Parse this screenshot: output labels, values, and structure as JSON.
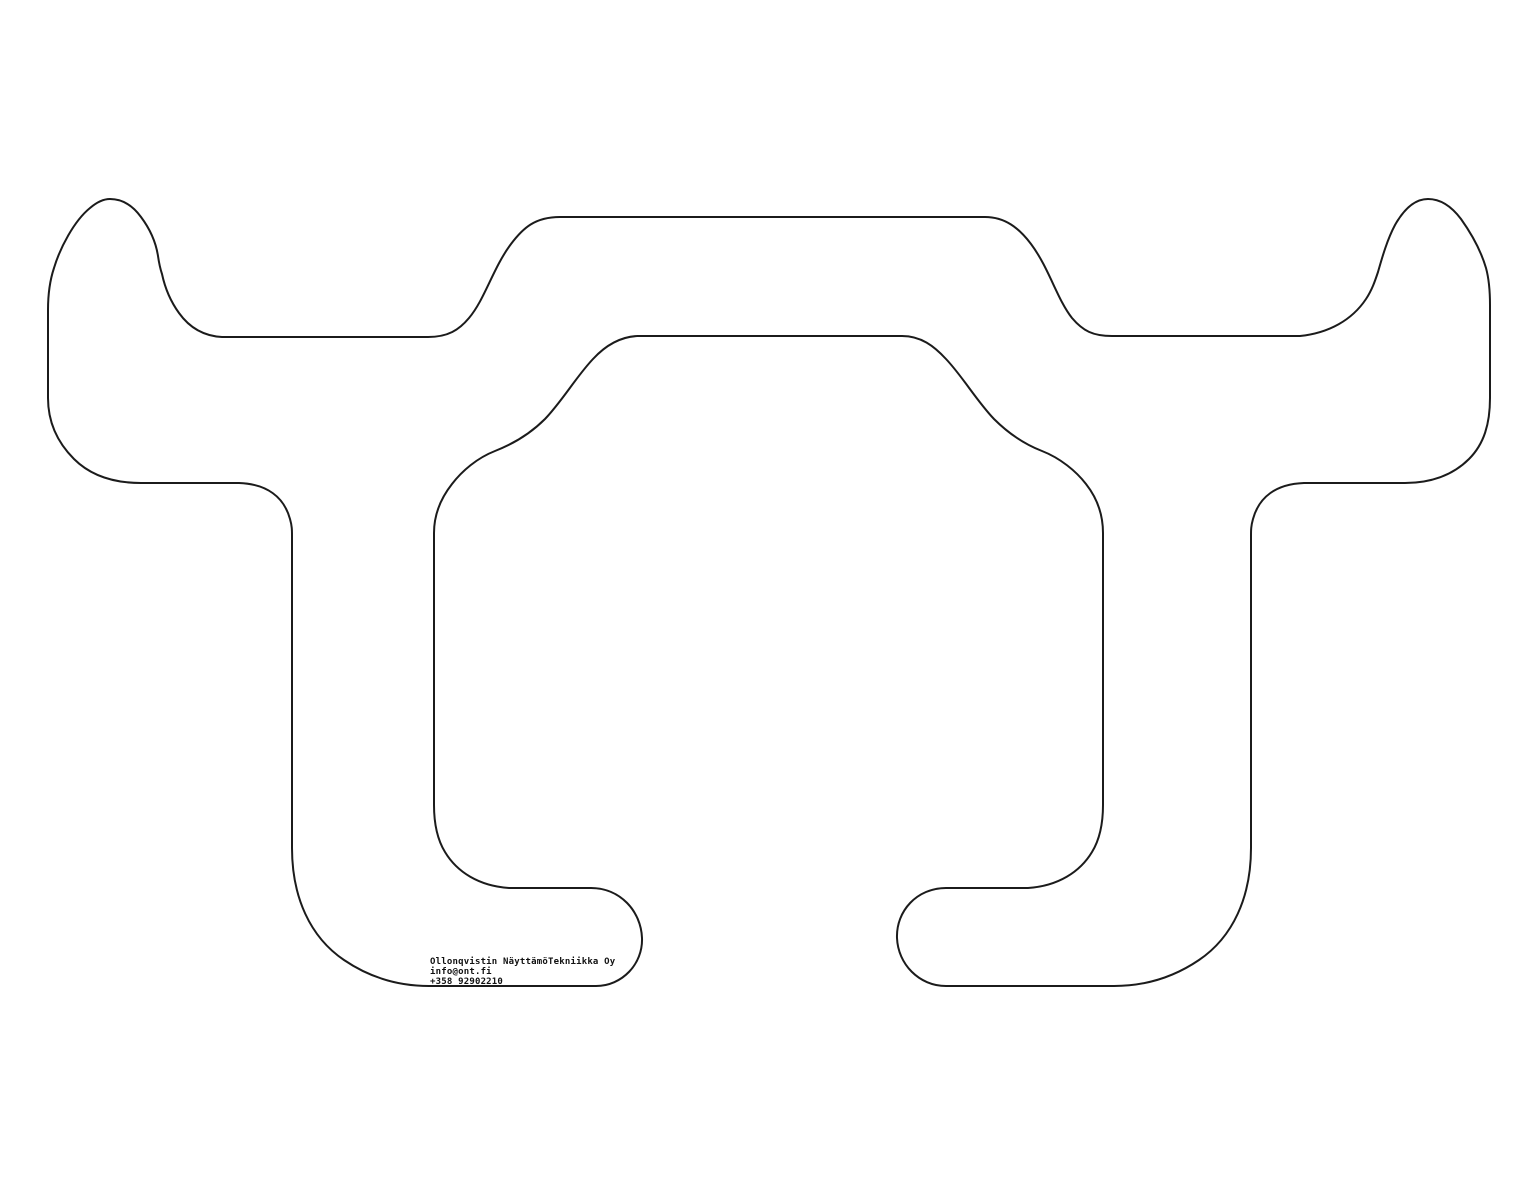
{
  "drawing": {
    "description": "technical cut-path outline drawing of a symmetric bracket-like shape",
    "stroke_color": "#1b1b1b",
    "background_color": "#ffffff",
    "label": {
      "company": "Ollonqvistin NäyttämöTekniikka Oy",
      "email": "info@ont.fi",
      "phone": "+358 92902210"
    }
  }
}
